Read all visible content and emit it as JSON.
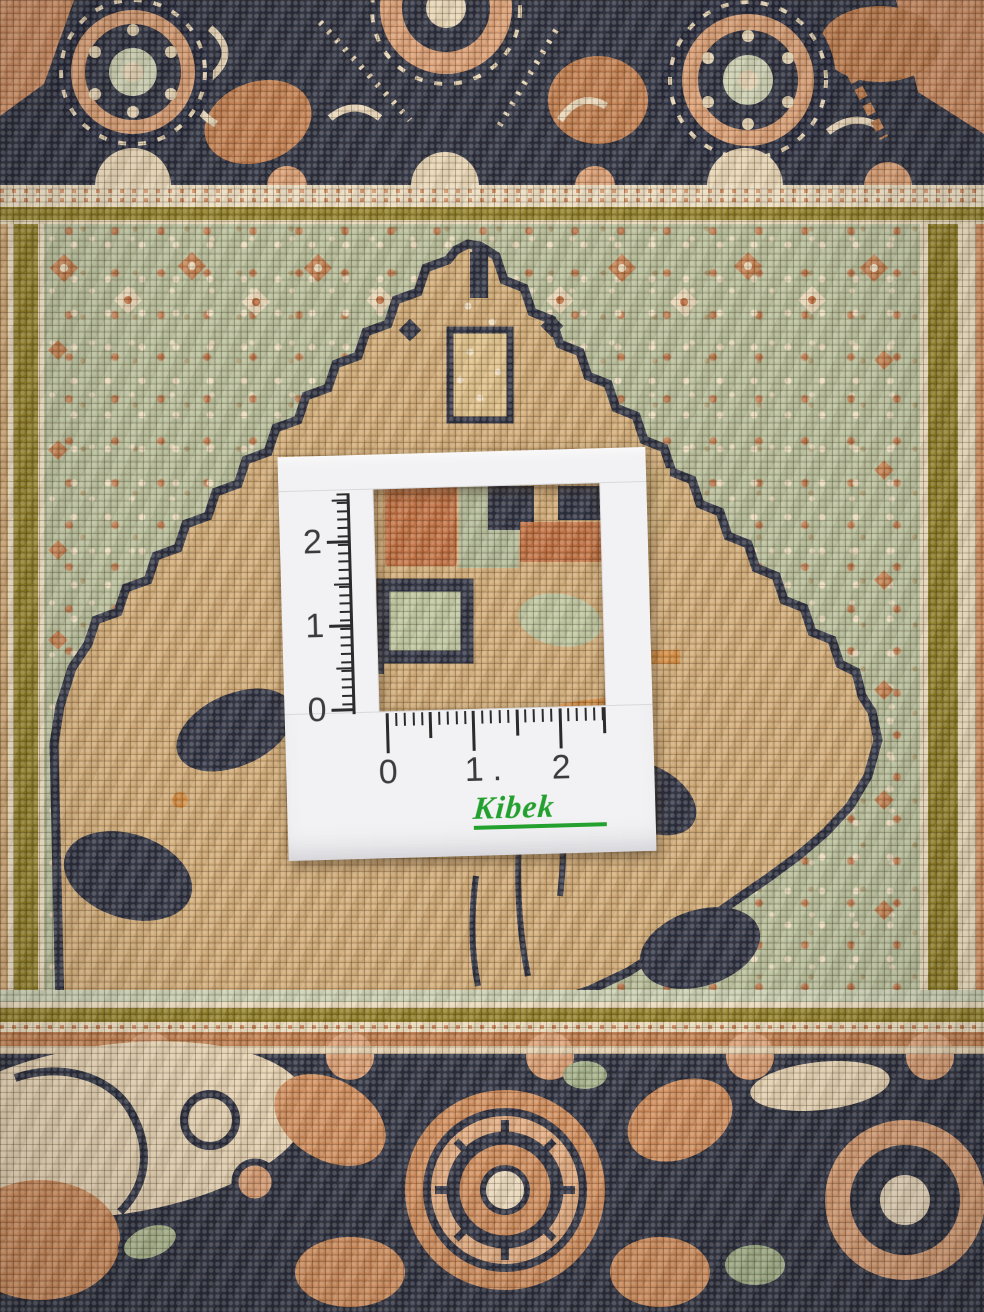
{
  "scene": {
    "type": "photograph",
    "subject": "close-up of a hand-knotted oriental rug with a paper measuring gauge card laid on top",
    "card": {
      "vruler": [
        "2",
        "1",
        "0"
      ],
      "hruler": [
        "0",
        "1",
        ".",
        "2"
      ],
      "logo": "Kibek",
      "logo_color": "#23a02d",
      "card_color": "#f2f2f4",
      "ruler_color": "#2b2b2b"
    },
    "carpet": {
      "palette": {
        "navy": "#262b3d",
        "tan": "#cfa873",
        "sage": "#b3bb97",
        "terracotta": "#c07a4a",
        "rust": "#b65c33",
        "salmon": "#d99b70",
        "cream": "#e8d6b6",
        "olive": "#8c7b22",
        "orange": "#d4893c"
      }
    }
  }
}
